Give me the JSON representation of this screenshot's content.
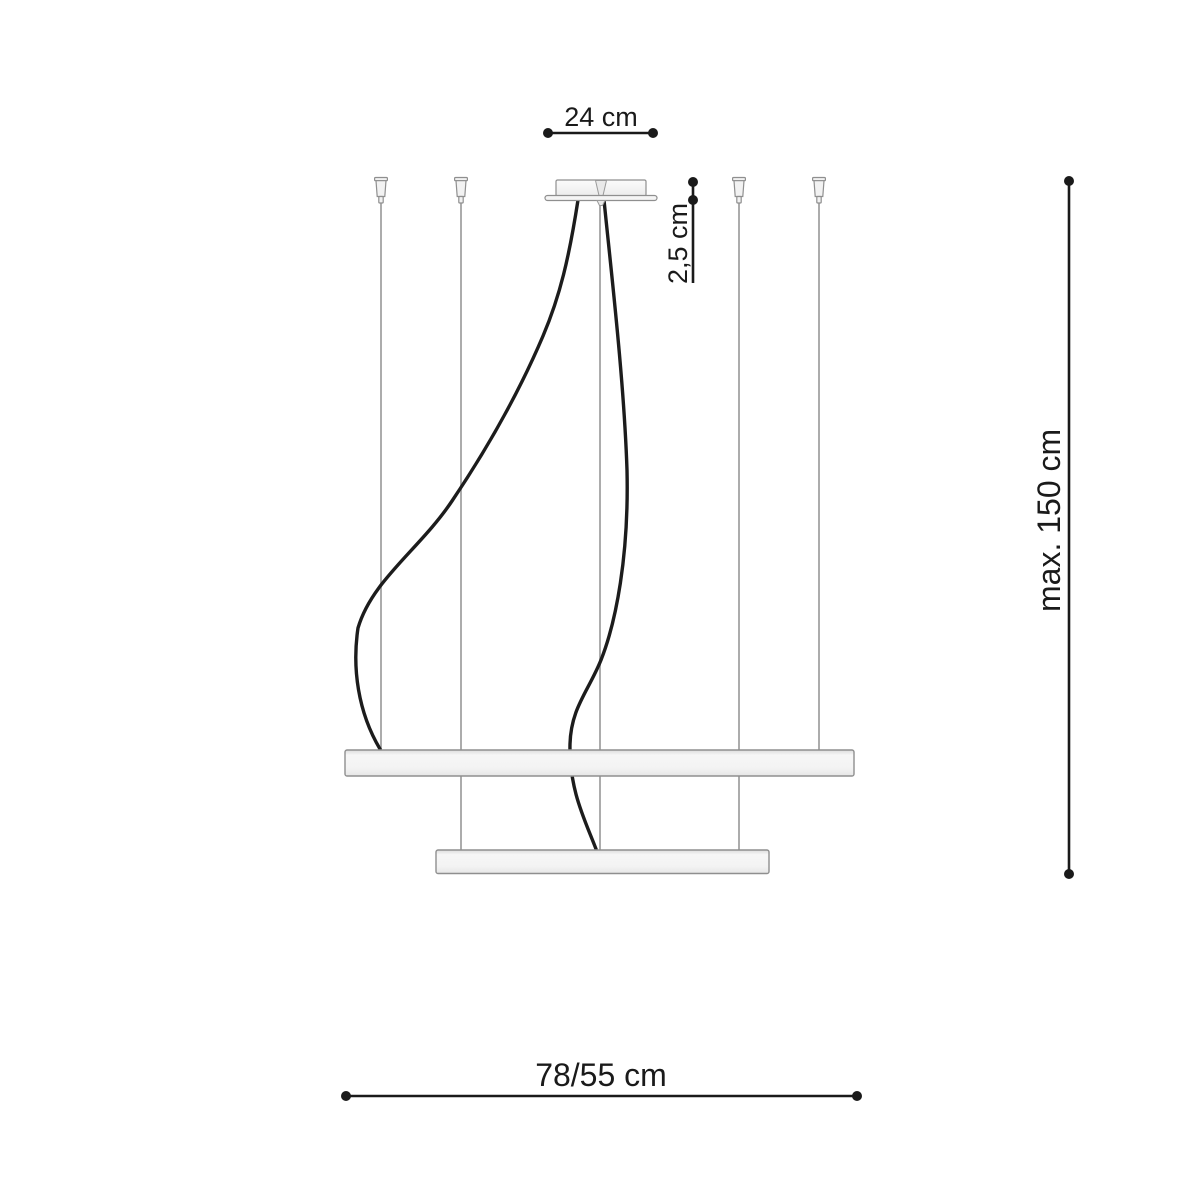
{
  "diagram": {
    "type": "pendant-lamp-dimension-drawing",
    "labels": {
      "canopy_width": "24 cm",
      "canopy_height": "2,5 cm",
      "max_drop": "max. 150 cm",
      "ring_diameters": "78/55 cm"
    },
    "colors": {
      "dimension": "#1a1a1a",
      "wire": "#acacac",
      "cable": "#1c1c1c",
      "fixture_fill": "#f2f2f2",
      "fixture_outline": "#8f8f8f",
      "background": "#ffffff"
    }
  }
}
